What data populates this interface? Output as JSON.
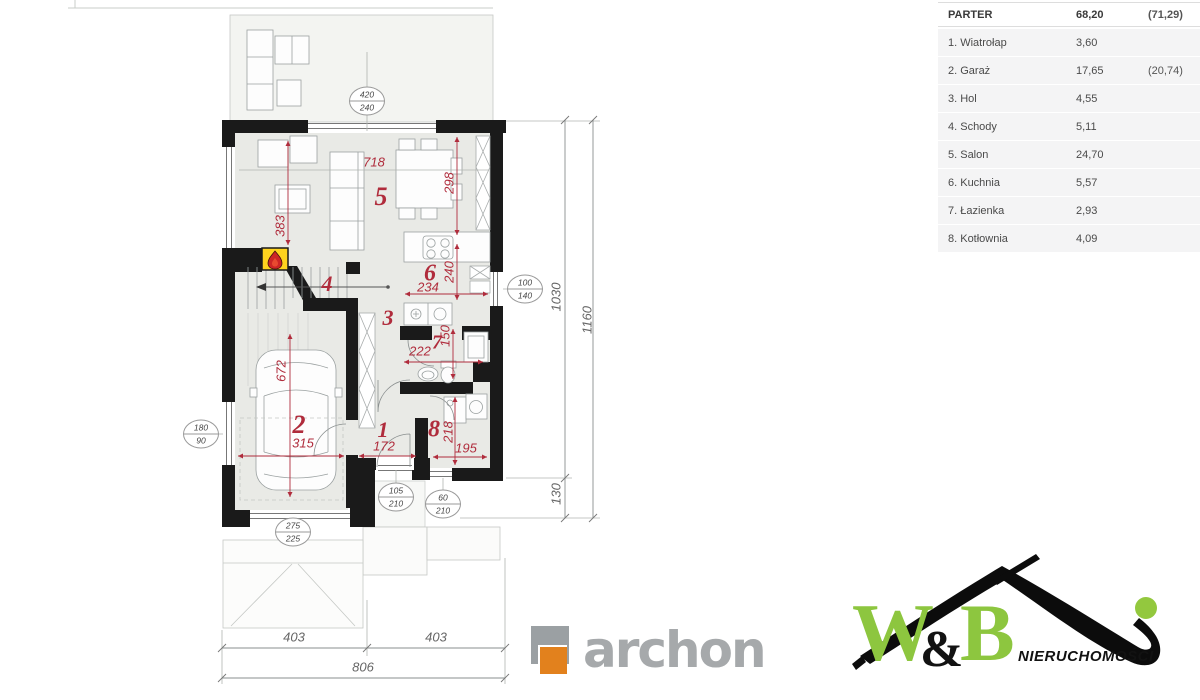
{
  "legend": {
    "header": {
      "name": "PARTER",
      "area": "68,20",
      "area_paren": "(71,29)"
    },
    "rows": [
      {
        "name": "1. Wiatrołap",
        "area": "3,60",
        "area_paren": ""
      },
      {
        "name": "2. Garaż",
        "area": "17,65",
        "area_paren": "(20,74)"
      },
      {
        "name": "3. Hol",
        "area": "4,55",
        "area_paren": ""
      },
      {
        "name": "4. Schody",
        "area": "5,11",
        "area_paren": ""
      },
      {
        "name": "5. Salon",
        "area": "24,70",
        "area_paren": ""
      },
      {
        "name": "6. Kuchnia",
        "area": "5,57",
        "area_paren": ""
      },
      {
        "name": "7. Łazienka",
        "area": "2,93",
        "area_paren": ""
      },
      {
        "name": "8. Kotłownia",
        "area": "4,09",
        "area_paren": ""
      }
    ]
  },
  "plan": {
    "room_numbers": [
      {
        "text": "1"
      },
      {
        "text": "2"
      },
      {
        "text": "3"
      },
      {
        "text": "4"
      },
      {
        "text": "5"
      },
      {
        "text": "6"
      },
      {
        "text": "7"
      },
      {
        "text": "8"
      }
    ],
    "red_dims": [
      {
        "text": "718"
      },
      {
        "text": "298"
      },
      {
        "text": "383"
      },
      {
        "text": "234"
      },
      {
        "text": "240"
      },
      {
        "text": "222"
      },
      {
        "text": "150"
      },
      {
        "text": "672"
      },
      {
        "text": "315"
      },
      {
        "text": "172"
      },
      {
        "text": "218"
      },
      {
        "text": "195"
      }
    ],
    "gray_dims": [
      {
        "text": "1030"
      },
      {
        "text": "1160"
      },
      {
        "text": "130"
      },
      {
        "text": "403"
      },
      {
        "text": "403"
      },
      {
        "text": "806"
      }
    ],
    "badges": [
      {
        "top": "420",
        "bottom": "240"
      },
      {
        "top": "100",
        "bottom": "140"
      },
      {
        "top": "180",
        "bottom": "90"
      },
      {
        "top": "105",
        "bottom": "210"
      },
      {
        "top": "60",
        "bottom": "210"
      },
      {
        "top": "275",
        "bottom": "225"
      }
    ]
  },
  "logos": {
    "archon": {
      "text": "archon"
    },
    "wb": {
      "w": "W",
      "amp": "&",
      "b": "B",
      "sub": "NIERUCHOMOŚCI"
    }
  },
  "colors": {
    "wall": "#1a1a1a",
    "dim_red": "#b02c3c",
    "fireplace_yellow": "#ffd31e",
    "archon_orange": "#e2811d",
    "archon_gray": "#a6a9ab",
    "wb_green": "#8dc63f",
    "floor": "#e9eae6"
  }
}
